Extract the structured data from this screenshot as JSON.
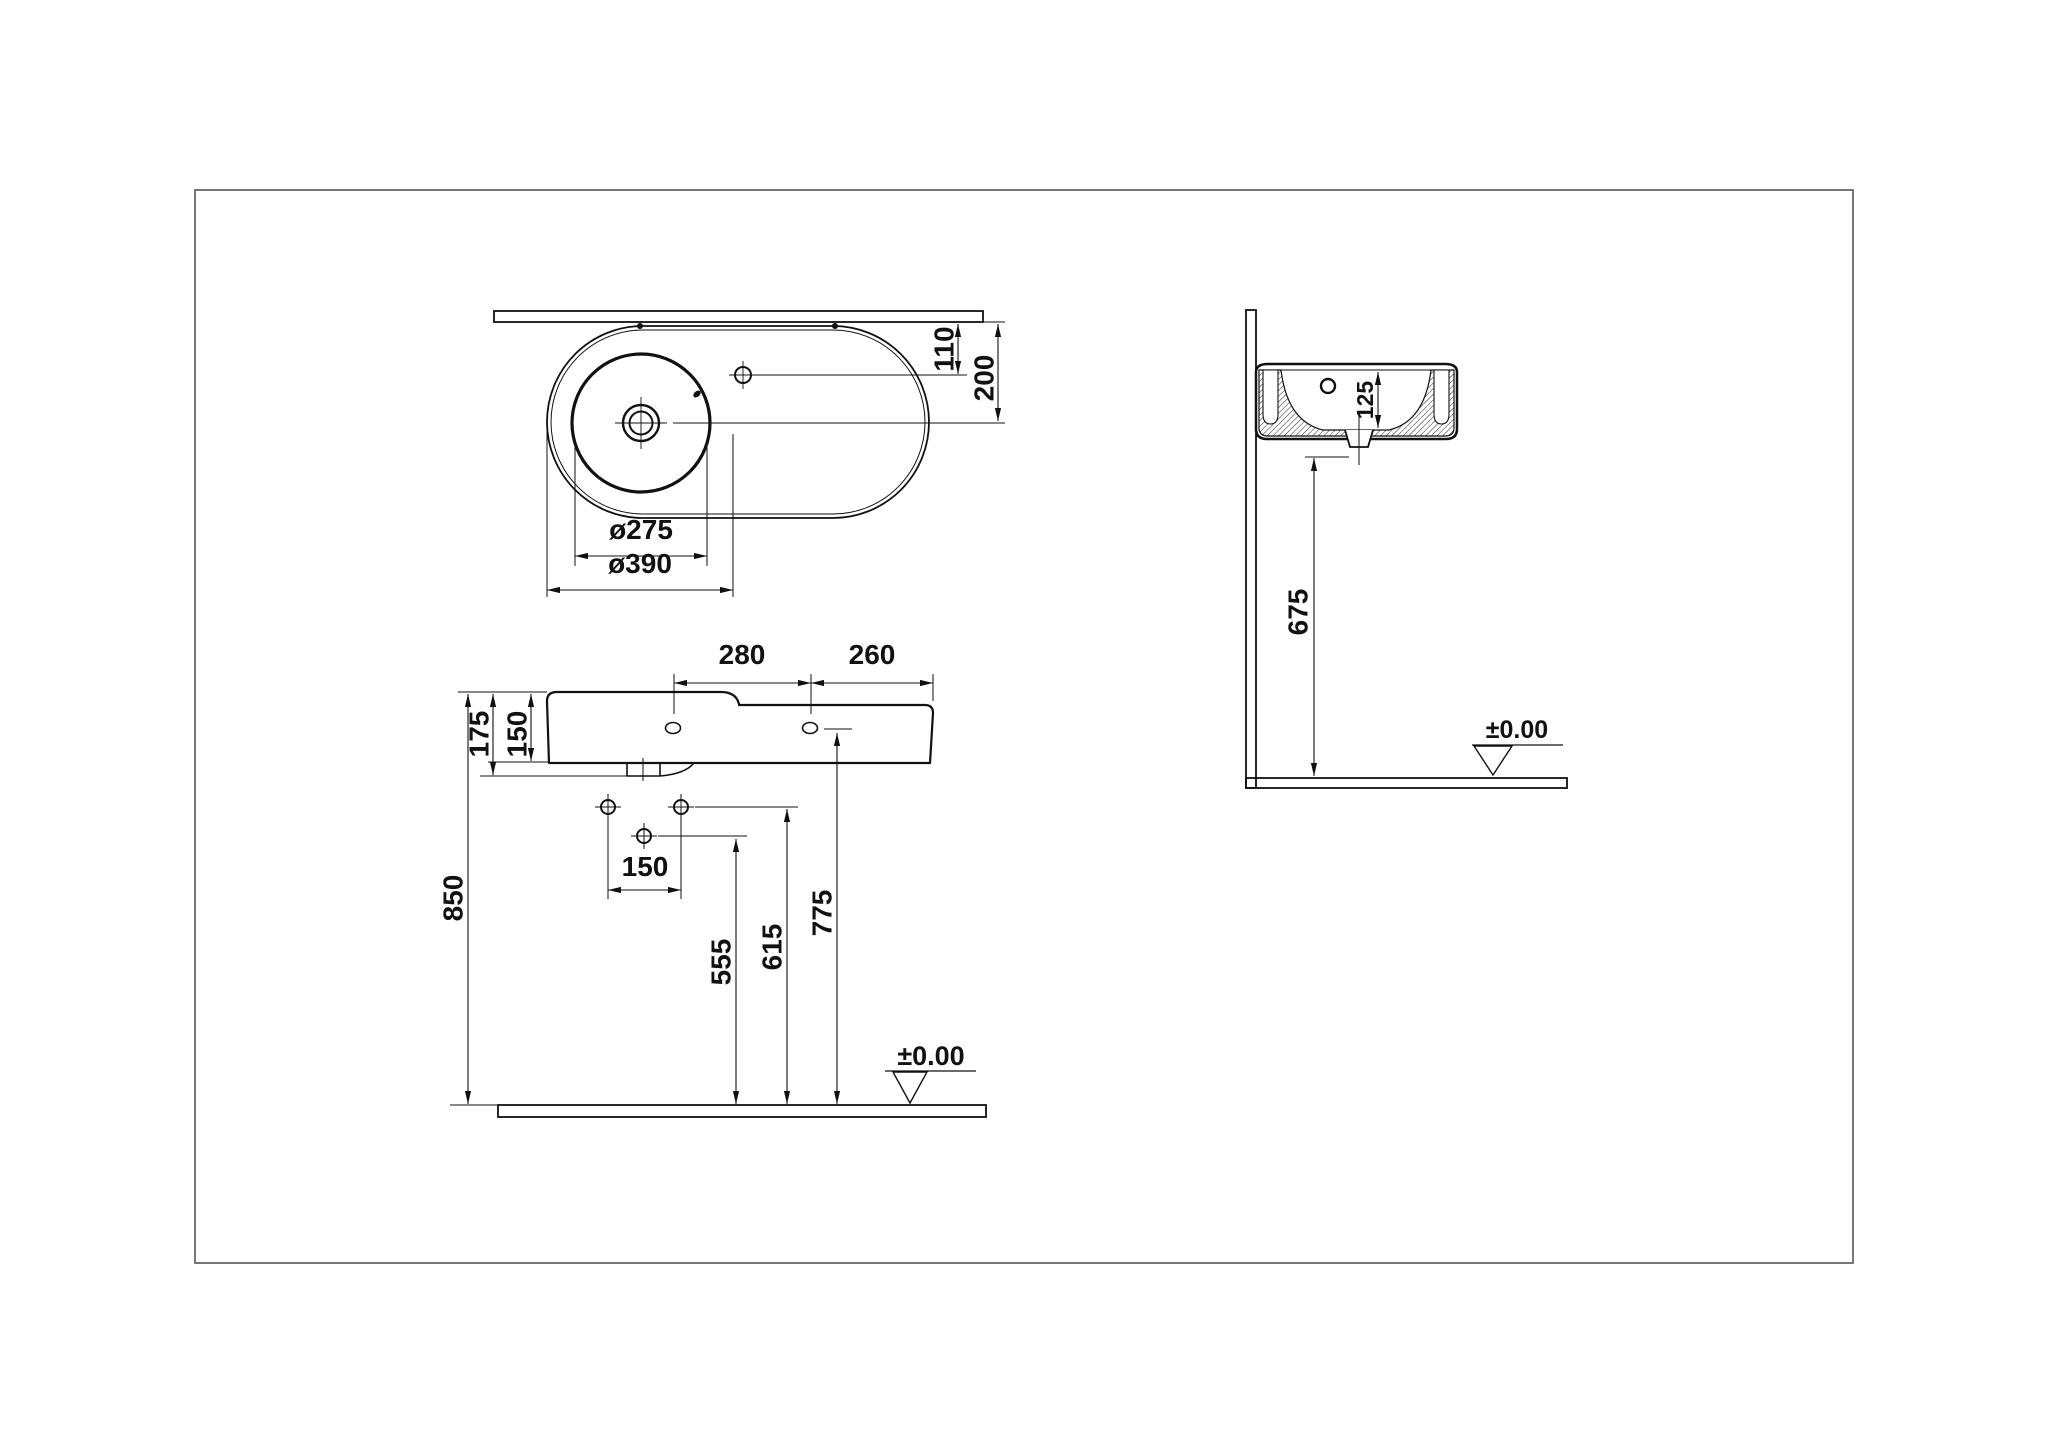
{
  "colors": {
    "line": "#111111",
    "frame": "#555555",
    "background": "#ffffff"
  },
  "top_view": {
    "dim_faucet_to_wall": "110",
    "dim_center_to_wall": "200",
    "dim_bowl_diameter": "ø275",
    "dim_deck_diameter": "ø390"
  },
  "front_view": {
    "dim_hole_span": "280",
    "dim_right_section": "260",
    "dim_total_edge_height": "175",
    "dim_body_height": "150",
    "dim_fixing_hole_span": "150",
    "dim_rim_height": "850",
    "dim_lower_hole_height": "555",
    "dim_upper_hole_height": "615",
    "dim_face_hole_height": "775",
    "datum": "±0.00"
  },
  "side_view": {
    "dim_bowl_depth": "125",
    "dim_trap_height": "675",
    "datum": "±0.00"
  }
}
